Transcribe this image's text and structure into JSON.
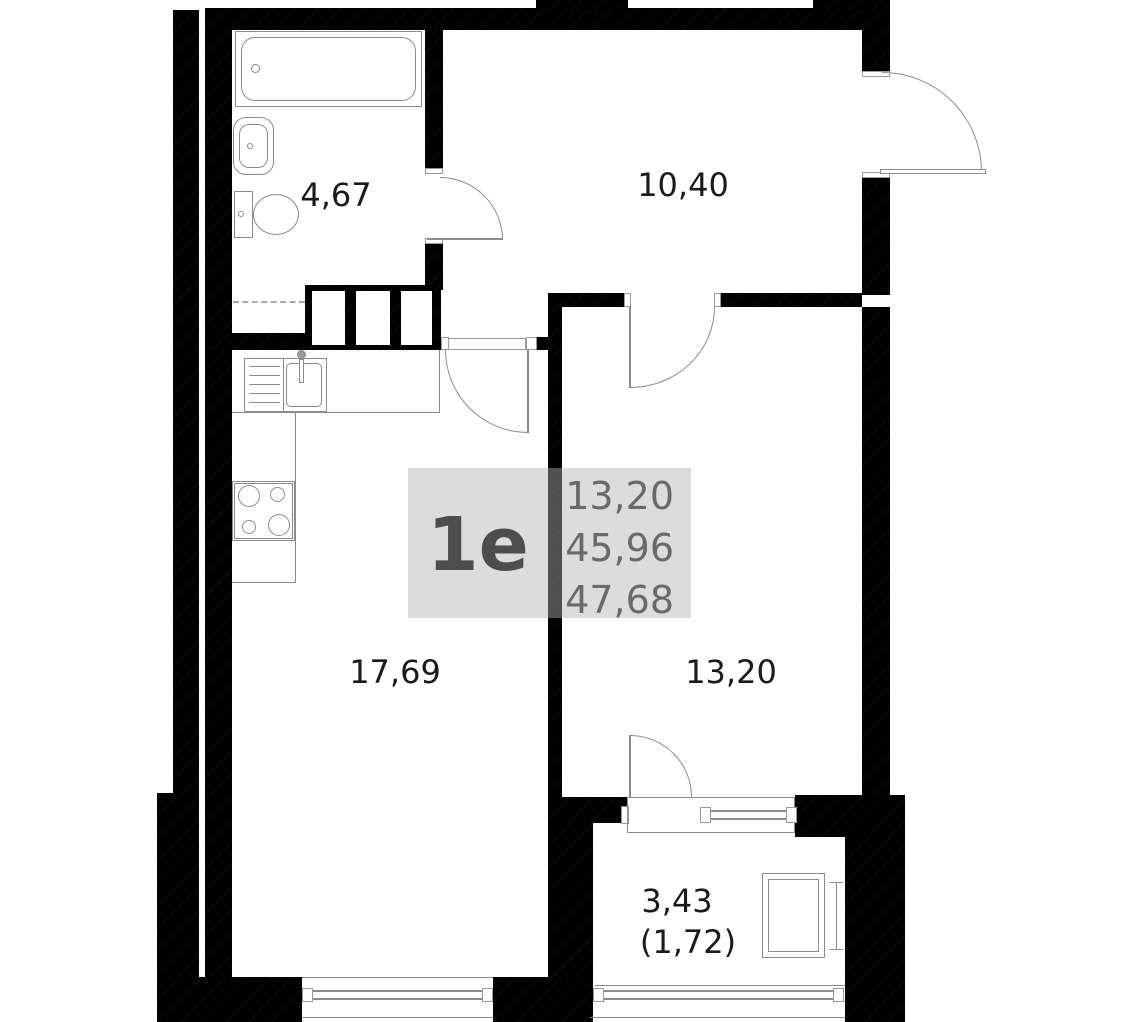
{
  "plan_title": "Floor plan unit 1e",
  "unit_card": {
    "unit": "1e",
    "lines": [
      "13,20",
      "45,96",
      "47,68"
    ]
  },
  "rooms": {
    "bathroom": "4,67",
    "hallway": "10,40",
    "living_kitchen": "17,69",
    "bedroom": "13,20",
    "balcony_total": "3,43",
    "balcony_reduced": "(1,72)"
  },
  "icons": {
    "bathtub": "bathtub-icon",
    "wash_basin": "wash-basin-icon",
    "toilet": "toilet-icon",
    "kitchen_sink": "kitchen-sink-icon",
    "stove": "stove-icon",
    "cabinet": "cabinet-icon"
  },
  "colors": {
    "wall": "#000000",
    "fixture_line": "#8c8c8c",
    "label_text": "#1a1a1a",
    "card_bg": "#b2b2b2",
    "card_unit_text": "#4d4d4d",
    "card_values_text": "#696969"
  }
}
